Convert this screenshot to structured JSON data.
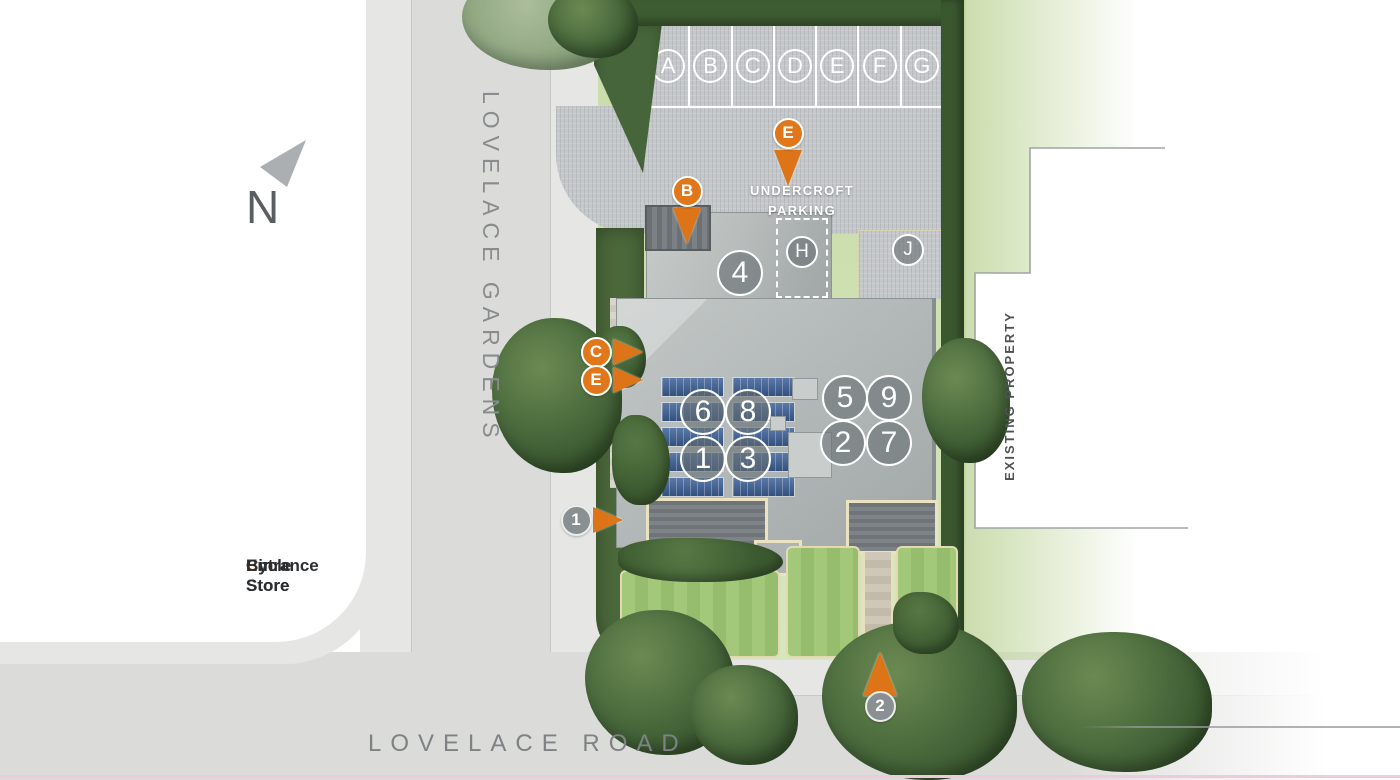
{
  "plan": {
    "compass_label": "N",
    "road_vertical_label": "LOVELACE GARDENS",
    "road_bottom_label": "LOVELACE ROAD",
    "existing_property_label": "EXISTING PROPERTY",
    "undercroft": {
      "line1": "UNDERCROFT",
      "line2": "PARKING"
    }
  },
  "parking": {
    "stalls": [
      "A",
      "B",
      "C",
      "D",
      "E",
      "F",
      "G"
    ]
  },
  "units": [
    {
      "label": "4",
      "x": 740,
      "y": 273,
      "size": "lg"
    },
    {
      "label": "H",
      "x": 802,
      "y": 252,
      "size": "sm"
    },
    {
      "label": "J",
      "x": 908,
      "y": 250,
      "size": "sm"
    },
    {
      "label": "6",
      "x": 703,
      "y": 412,
      "size": "lg"
    },
    {
      "label": "8",
      "x": 748,
      "y": 412,
      "size": "lg"
    },
    {
      "label": "1",
      "x": 703,
      "y": 459,
      "size": "lg"
    },
    {
      "label": "3",
      "x": 748,
      "y": 459,
      "size": "lg"
    },
    {
      "label": "5",
      "x": 845,
      "y": 398,
      "size": "lg"
    },
    {
      "label": "9",
      "x": 889,
      "y": 398,
      "size": "lg"
    },
    {
      "label": "2",
      "x": 843,
      "y": 443,
      "size": "lg"
    },
    {
      "label": "7",
      "x": 889,
      "y": 443,
      "size": "lg"
    }
  ],
  "markers": [
    {
      "label": "E",
      "x": 788,
      "y": 133,
      "pointer": "down",
      "style": "orange"
    },
    {
      "label": "B",
      "x": 687,
      "y": 191,
      "pointer": "down",
      "style": "orange"
    },
    {
      "label": "C",
      "x": 596,
      "y": 352,
      "pointer": "right",
      "style": "orange"
    },
    {
      "label": "E",
      "x": 596,
      "y": 380,
      "pointer": "right",
      "style": "orange"
    },
    {
      "label": "1",
      "x": 576,
      "y": 520,
      "pointer": "right",
      "style": "grey"
    },
    {
      "label": "2",
      "x": 880,
      "y": 706,
      "pointer": "up",
      "style": "grey"
    }
  ],
  "legend": {
    "separator": ":",
    "items": [
      {
        "key": "E",
        "label": "Entrance"
      },
      {
        "key": "B",
        "label": "Bin Store"
      },
      {
        "key": "C",
        "label": "Cycle Store"
      }
    ]
  },
  "colors": {
    "accent_orange": "#e0771b",
    "roof_grey": "#b2b8b7",
    "lawn_green": "#a4c87a",
    "hedge_green": "#3e5c31",
    "road_grey": "#dbdcda",
    "solar_blue": "#33507e",
    "boundary_pink": "#edcbdd"
  }
}
